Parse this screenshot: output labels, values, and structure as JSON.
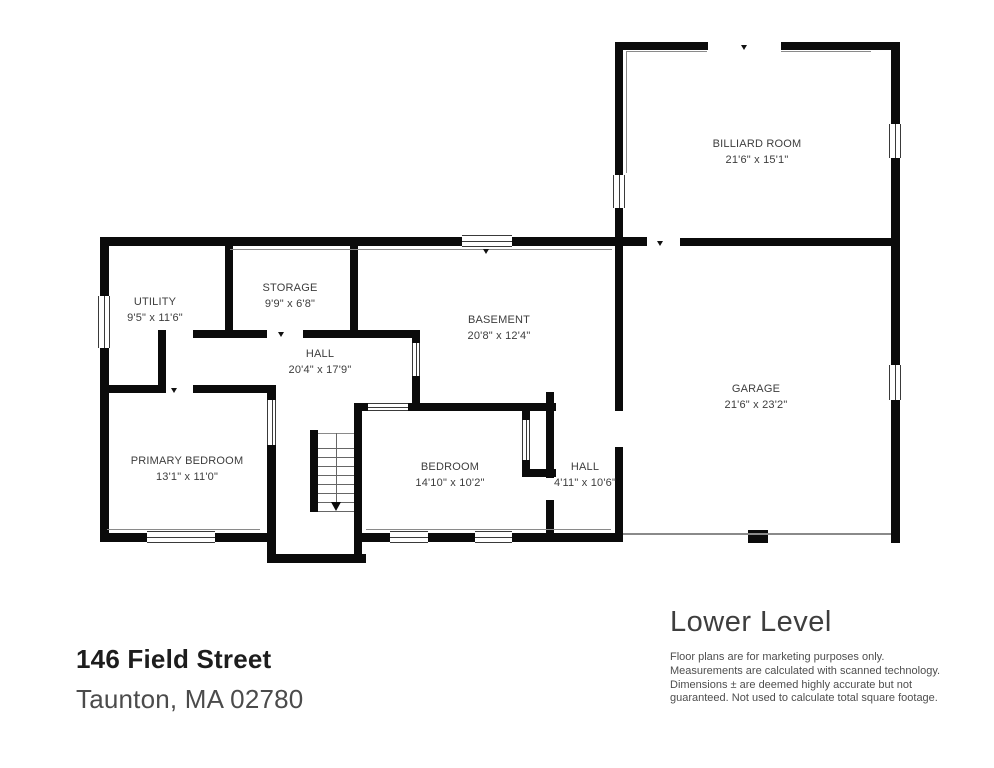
{
  "property": {
    "address_line1": "146 Field Street",
    "address_line2": "Taunton, MA 02780"
  },
  "plan": {
    "level_title": "Lower Level",
    "disclaimer_lines": [
      "Floor plans are for marketing purposes only.",
      "Measurements are calculated with scanned technology.",
      "Dimensions ± are deemed highly accurate but not",
      "guaranteed. Not used to calculate total square footage."
    ],
    "rooms": [
      {
        "name": "BILLIARD ROOM",
        "dims": "21'6\" x 15'1\""
      },
      {
        "name": "UTILITY",
        "dims": "9'5\" x 11'6\""
      },
      {
        "name": "STORAGE",
        "dims": "9'9\" x 6'8\""
      },
      {
        "name": "BASEMENT",
        "dims": "20'8\" x 12'4\""
      },
      {
        "name": "HALL",
        "dims": "20'4\" x 17'9\""
      },
      {
        "name": "GARAGE",
        "dims": "21'6\" x 23'2\""
      },
      {
        "name": "PRIMARY BEDROOM",
        "dims": "13'1\" x 11'0\""
      },
      {
        "name": "BEDROOM",
        "dims": "14'10\" x 10'2\""
      },
      {
        "name": "HALL",
        "dims": "4'11\" x 10'6\""
      }
    ],
    "colors": {
      "wall": "#0b0b0b",
      "label_text": "#3d3d3d",
      "background": "#ffffff"
    }
  }
}
